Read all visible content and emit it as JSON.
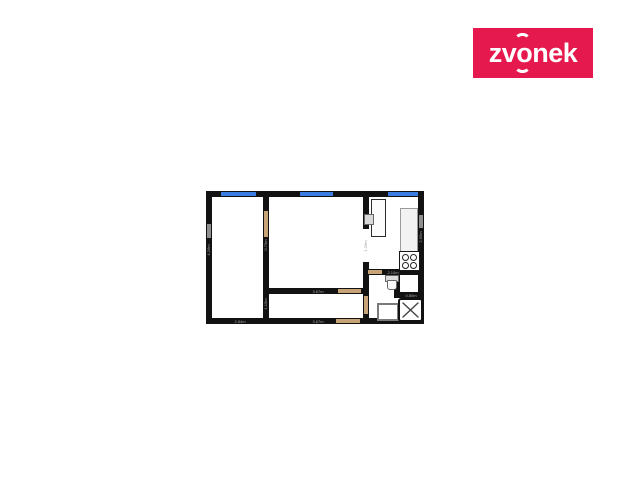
{
  "brand": {
    "name": "zvonek",
    "background_color": "#e5194d",
    "text_color": "#ffffff"
  },
  "floorplan": {
    "colors": {
      "wall": "#121212",
      "window": "#3b7ce0",
      "door": "#c7a477",
      "dimension_text": "#a9a9a9"
    },
    "dimensions": {
      "bedroom_bottom": "2.84m",
      "bedroom_left": "4.26m",
      "bedroom_door": "0.70m",
      "hall_top": "3.67m",
      "hall_bottom": "3.67m",
      "hall_left": "1.15m",
      "kitchen_bottom": "2.10m",
      "kitchen_right": "2.95m",
      "shower_top": "0.80m",
      "opening_right": "1.26m"
    }
  }
}
